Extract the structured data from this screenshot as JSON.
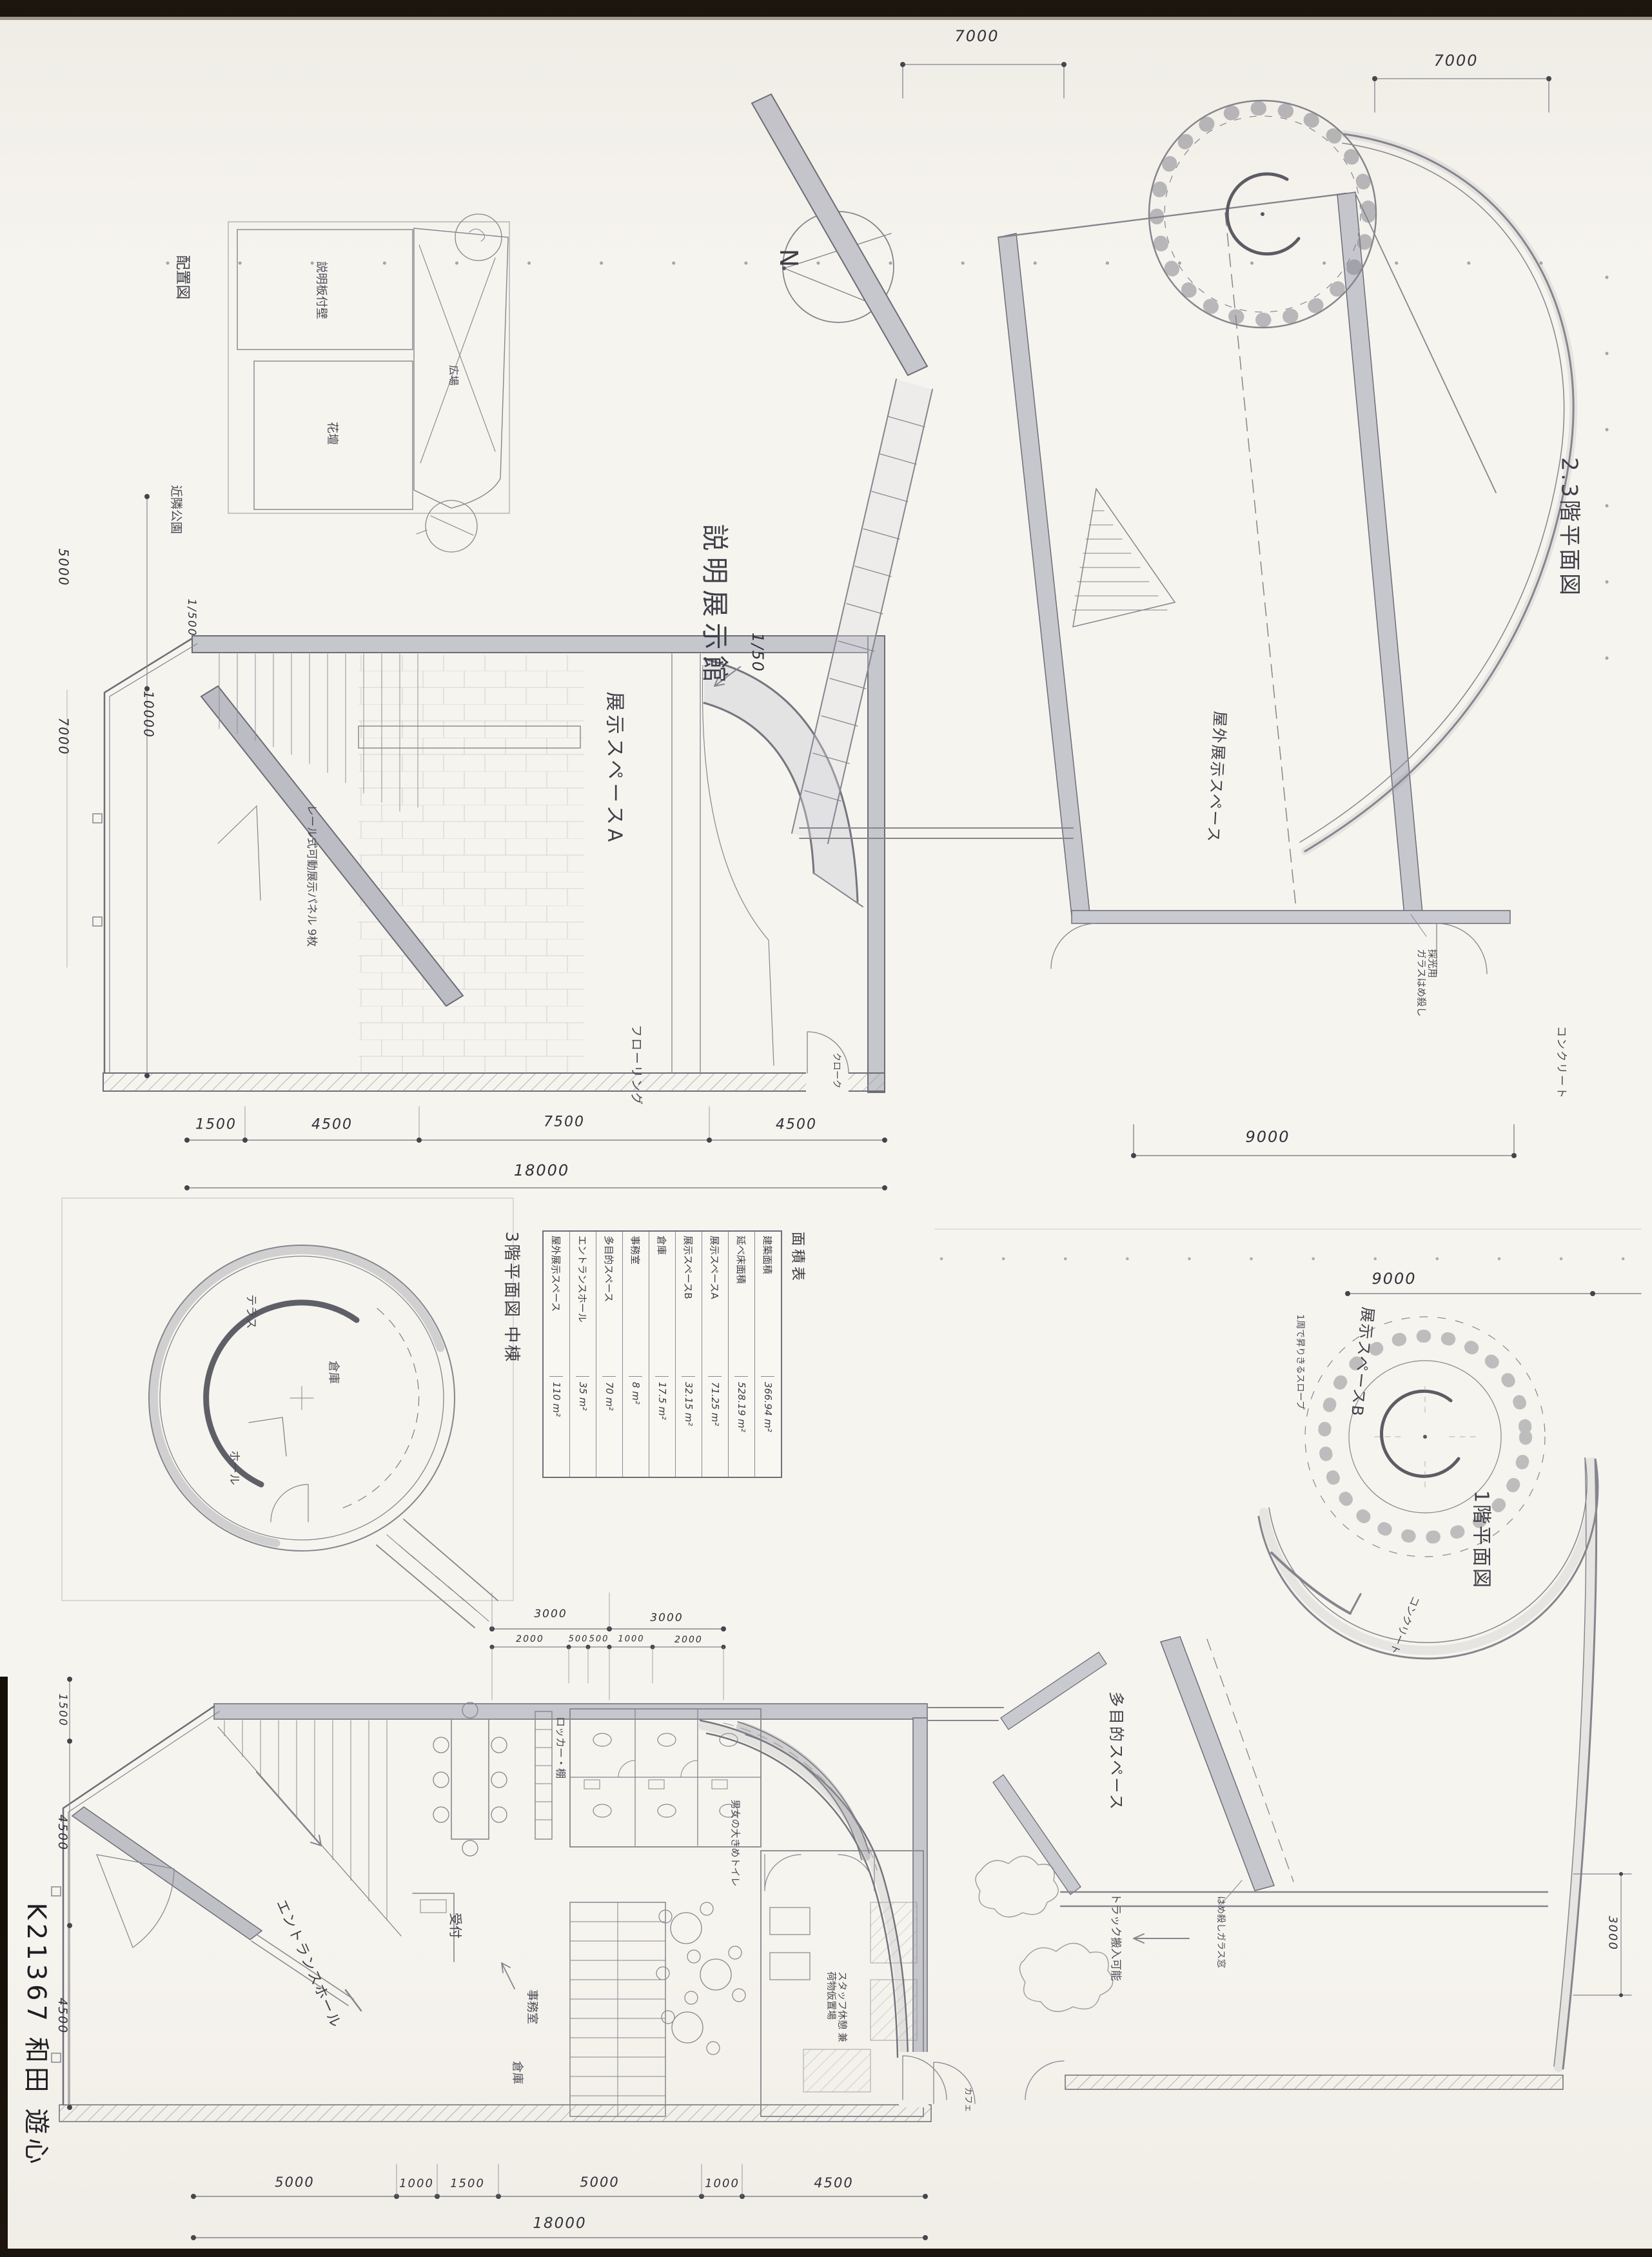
{
  "sheet": {
    "signature": "K21367 和田 遊心"
  },
  "title_block": {
    "project_title": "説明展示館",
    "scale": "1/50",
    "north": "N"
  },
  "site_plan": {
    "name": "配置図",
    "scale": "1/500",
    "park": "近隣公園",
    "board": "説明板付壁",
    "flowerbed": "花壇",
    "plaza": "広場"
  },
  "plan_2f3f": {
    "name": "2.3階平面図",
    "outdoor_exhibit": "屋外展示スペース",
    "glass_note1": "採光用",
    "glass_note2": "ガラスはめ殺し",
    "concrete": "コンクリート",
    "dim_top_a": "7000",
    "dim_top_b": "7000",
    "dim_bottom": "9000"
  },
  "plan_upper_left": {
    "exhibit_a": "展示スペースA",
    "flooring": "フローリング",
    "cloak": "クローク",
    "panel_note": "レール式可動展示パネル 9枚",
    "dim_left_1": "5000",
    "dim_left_2": "10000",
    "dim_left_3": "7000",
    "dims_bottom": [
      "1500",
      "4500",
      "7500",
      "4500"
    ],
    "dim_total": "18000"
  },
  "plan_3f": {
    "name": "3階平面図 中棟",
    "terrace": "テラス",
    "storage": "倉庫",
    "hall": "ホール"
  },
  "area_table": {
    "title": "面積表",
    "rows": [
      {
        "name": "建築面積",
        "value": "366.94 m²"
      },
      {
        "name": "延べ床面積",
        "value": "528.19 m²"
      },
      {
        "name": "展示スペースA",
        "value": "71.25 m²"
      },
      {
        "name": "展示スペースB",
        "value": "32.15 m²"
      },
      {
        "name": "倉庫",
        "value": "17.5 m²"
      },
      {
        "name": "事務室",
        "value": "8 m²"
      },
      {
        "name": "多目的スペース",
        "value": "70 m²"
      },
      {
        "name": "エントランスホール",
        "value": "35 m²"
      },
      {
        "name": "屋外展示スペース",
        "value": "110 m²"
      }
    ]
  },
  "plan_1f_left": {
    "entrance": "エントランスホール",
    "reception": "受付",
    "locker": "ロッカー・棚",
    "office": "事務室",
    "storage": "倉庫",
    "toilet": "男女の大きめトイレ",
    "staff1": "スタッフ休憩 兼",
    "staff2": "荷物仮置場",
    "cafe": "カフェ",
    "dim_left_1": "1500",
    "dim_left_2": "4500",
    "dim_left_3": "4500",
    "dims_mid_top": [
      "3000",
      "3000"
    ],
    "dims_mid_bottom": [
      "2000",
      "500",
      "500",
      "1000",
      "2000"
    ],
    "dims_bottom": [
      "5000",
      "1000",
      "1500",
      "5000",
      "1000",
      "4500"
    ],
    "dim_total": "18000"
  },
  "plan_1f_right": {
    "name": "1階平面図",
    "exhibit_b": "展示スペースB",
    "multi_purpose": "多目的スペース",
    "spiral_note": "1周で昇りきるスロープ",
    "concrete": "コンクリート",
    "truck_note": "トラック搬入可能",
    "glass_note": "はめ殺しガラス窓",
    "dim_top": "9000",
    "dim_right": "3000"
  }
}
